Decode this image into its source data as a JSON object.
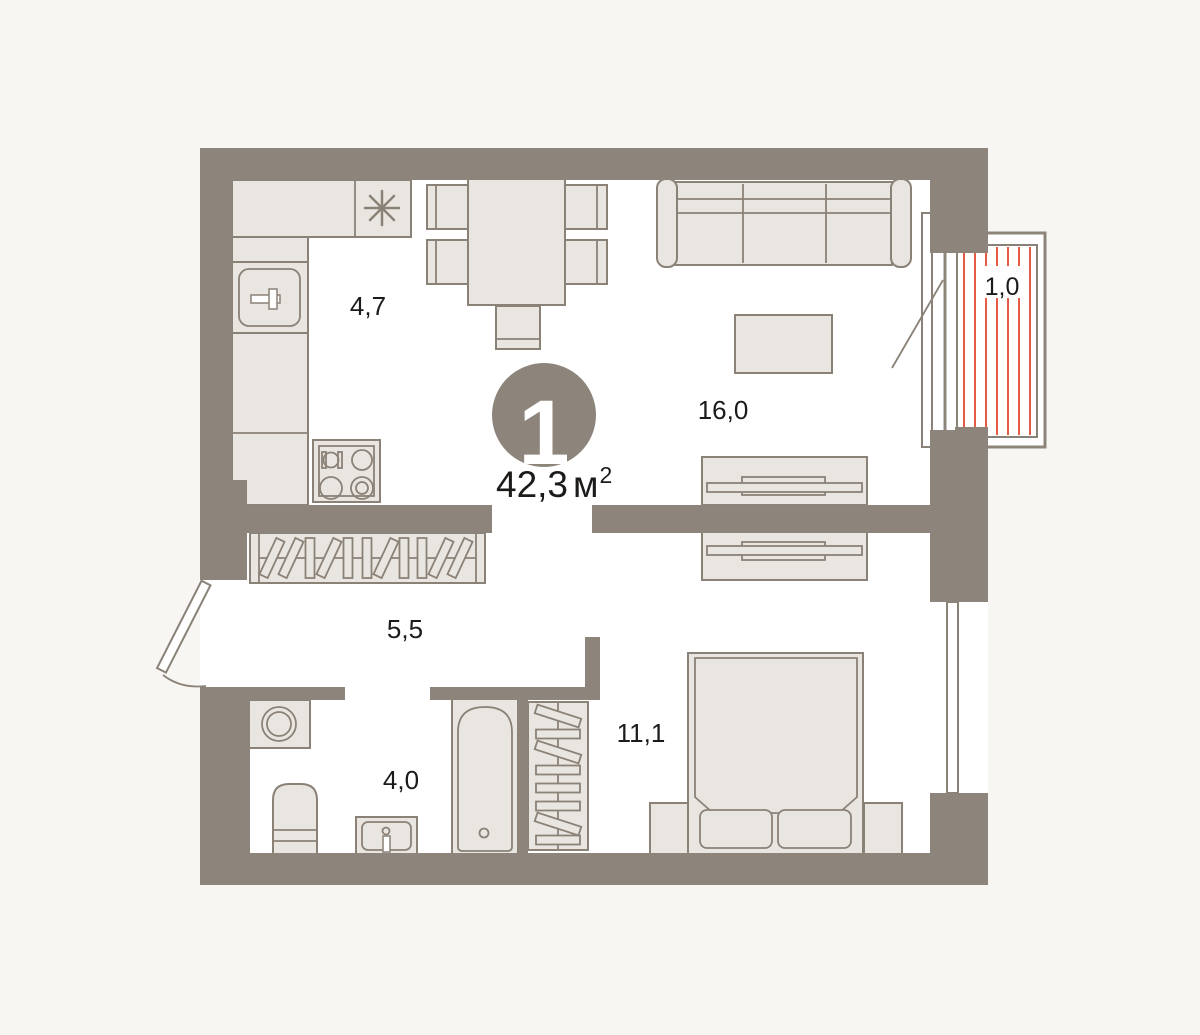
{
  "plan": {
    "number": "1",
    "total_area": {
      "value": "42,3",
      "unit": "м",
      "sup": "2"
    },
    "rooms": {
      "kitchen": {
        "name": "kitchen",
        "area": "4,7"
      },
      "living_room": {
        "name": "living-room",
        "area": "16,0"
      },
      "hallway": {
        "name": "hallway",
        "area": "5,5"
      },
      "bathroom": {
        "name": "bathroom",
        "area": "4,0"
      },
      "bedroom": {
        "name": "bedroom",
        "area": "11,1"
      },
      "balcony": {
        "name": "balcony",
        "area": "1,0"
      }
    }
  },
  "colors": {
    "background": "#f7f6f3",
    "floor": "#ffffff",
    "wall": "#8d857c",
    "furniture_fill": "#e9e6e1",
    "furniture_stroke": "#8a8177",
    "balcony_hatch": "#e65b43",
    "text": "#1d1b19",
    "badge_fill": "#8d857c",
    "badge_text": "#ffffff"
  }
}
